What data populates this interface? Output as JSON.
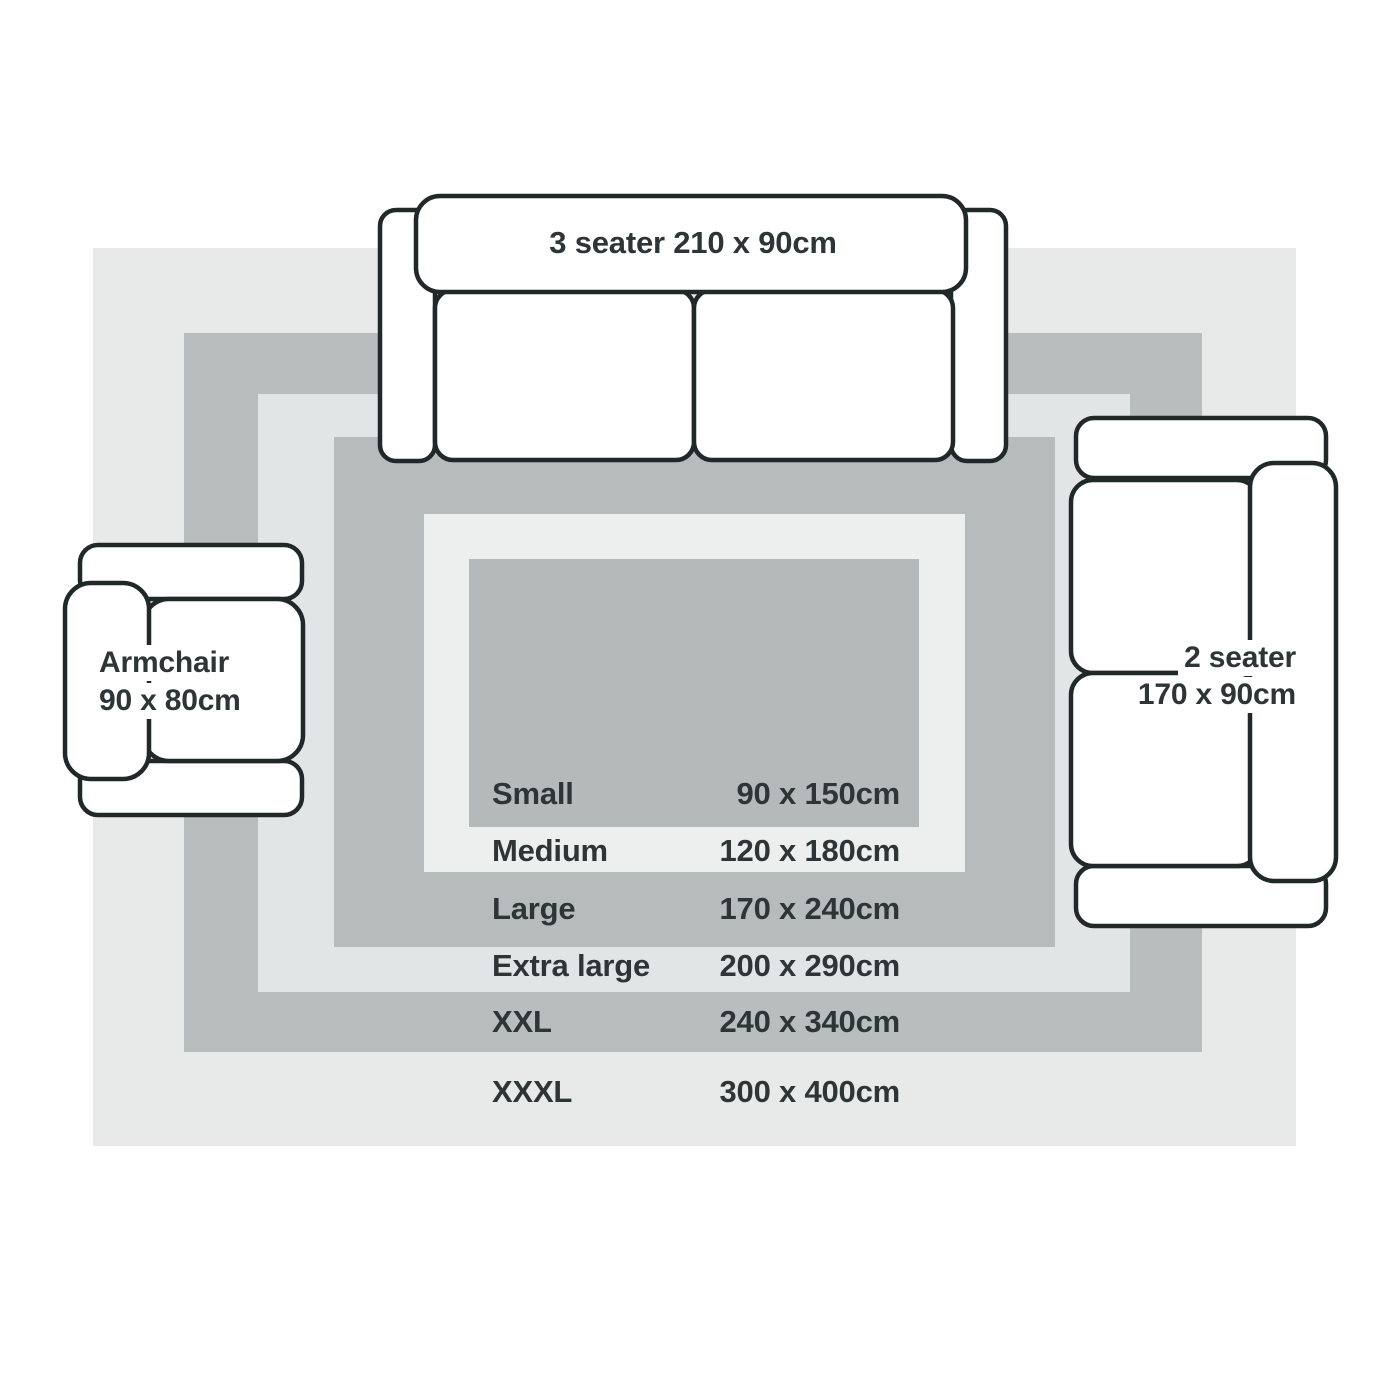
{
  "rugs": [
    {
      "name": "Small",
      "dims": "90 x 150cm",
      "color": "#b4b9b9"
    },
    {
      "name": "Medium",
      "dims": "120 x 180cm",
      "color": "#edefef"
    },
    {
      "name": "Large",
      "dims": "170 x 240cm",
      "color": "#b6bbbb"
    },
    {
      "name": "Extra large",
      "dims": "200 x 290cm",
      "color": "#e2e5e5"
    },
    {
      "name": "XXL",
      "dims": "240 x 340cm",
      "color": "#b8bdbd"
    },
    {
      "name": "XXXL",
      "dims": "300 x 400cm",
      "color": "#e8eaea"
    }
  ],
  "furniture": {
    "sofa_3_seater": {
      "label": "3 seater 210 x 90cm"
    },
    "sofa_2_seater": {
      "label_line1": "2 seater",
      "label_line2": "170 x 90cm"
    },
    "armchair": {
      "label_line1": "Armchair",
      "label_line2": "90 x 80cm"
    }
  },
  "colors": {
    "background": "#ffffff",
    "furniture_fill": "#ffffff",
    "outline": "#212829",
    "text": "#2e3537"
  }
}
